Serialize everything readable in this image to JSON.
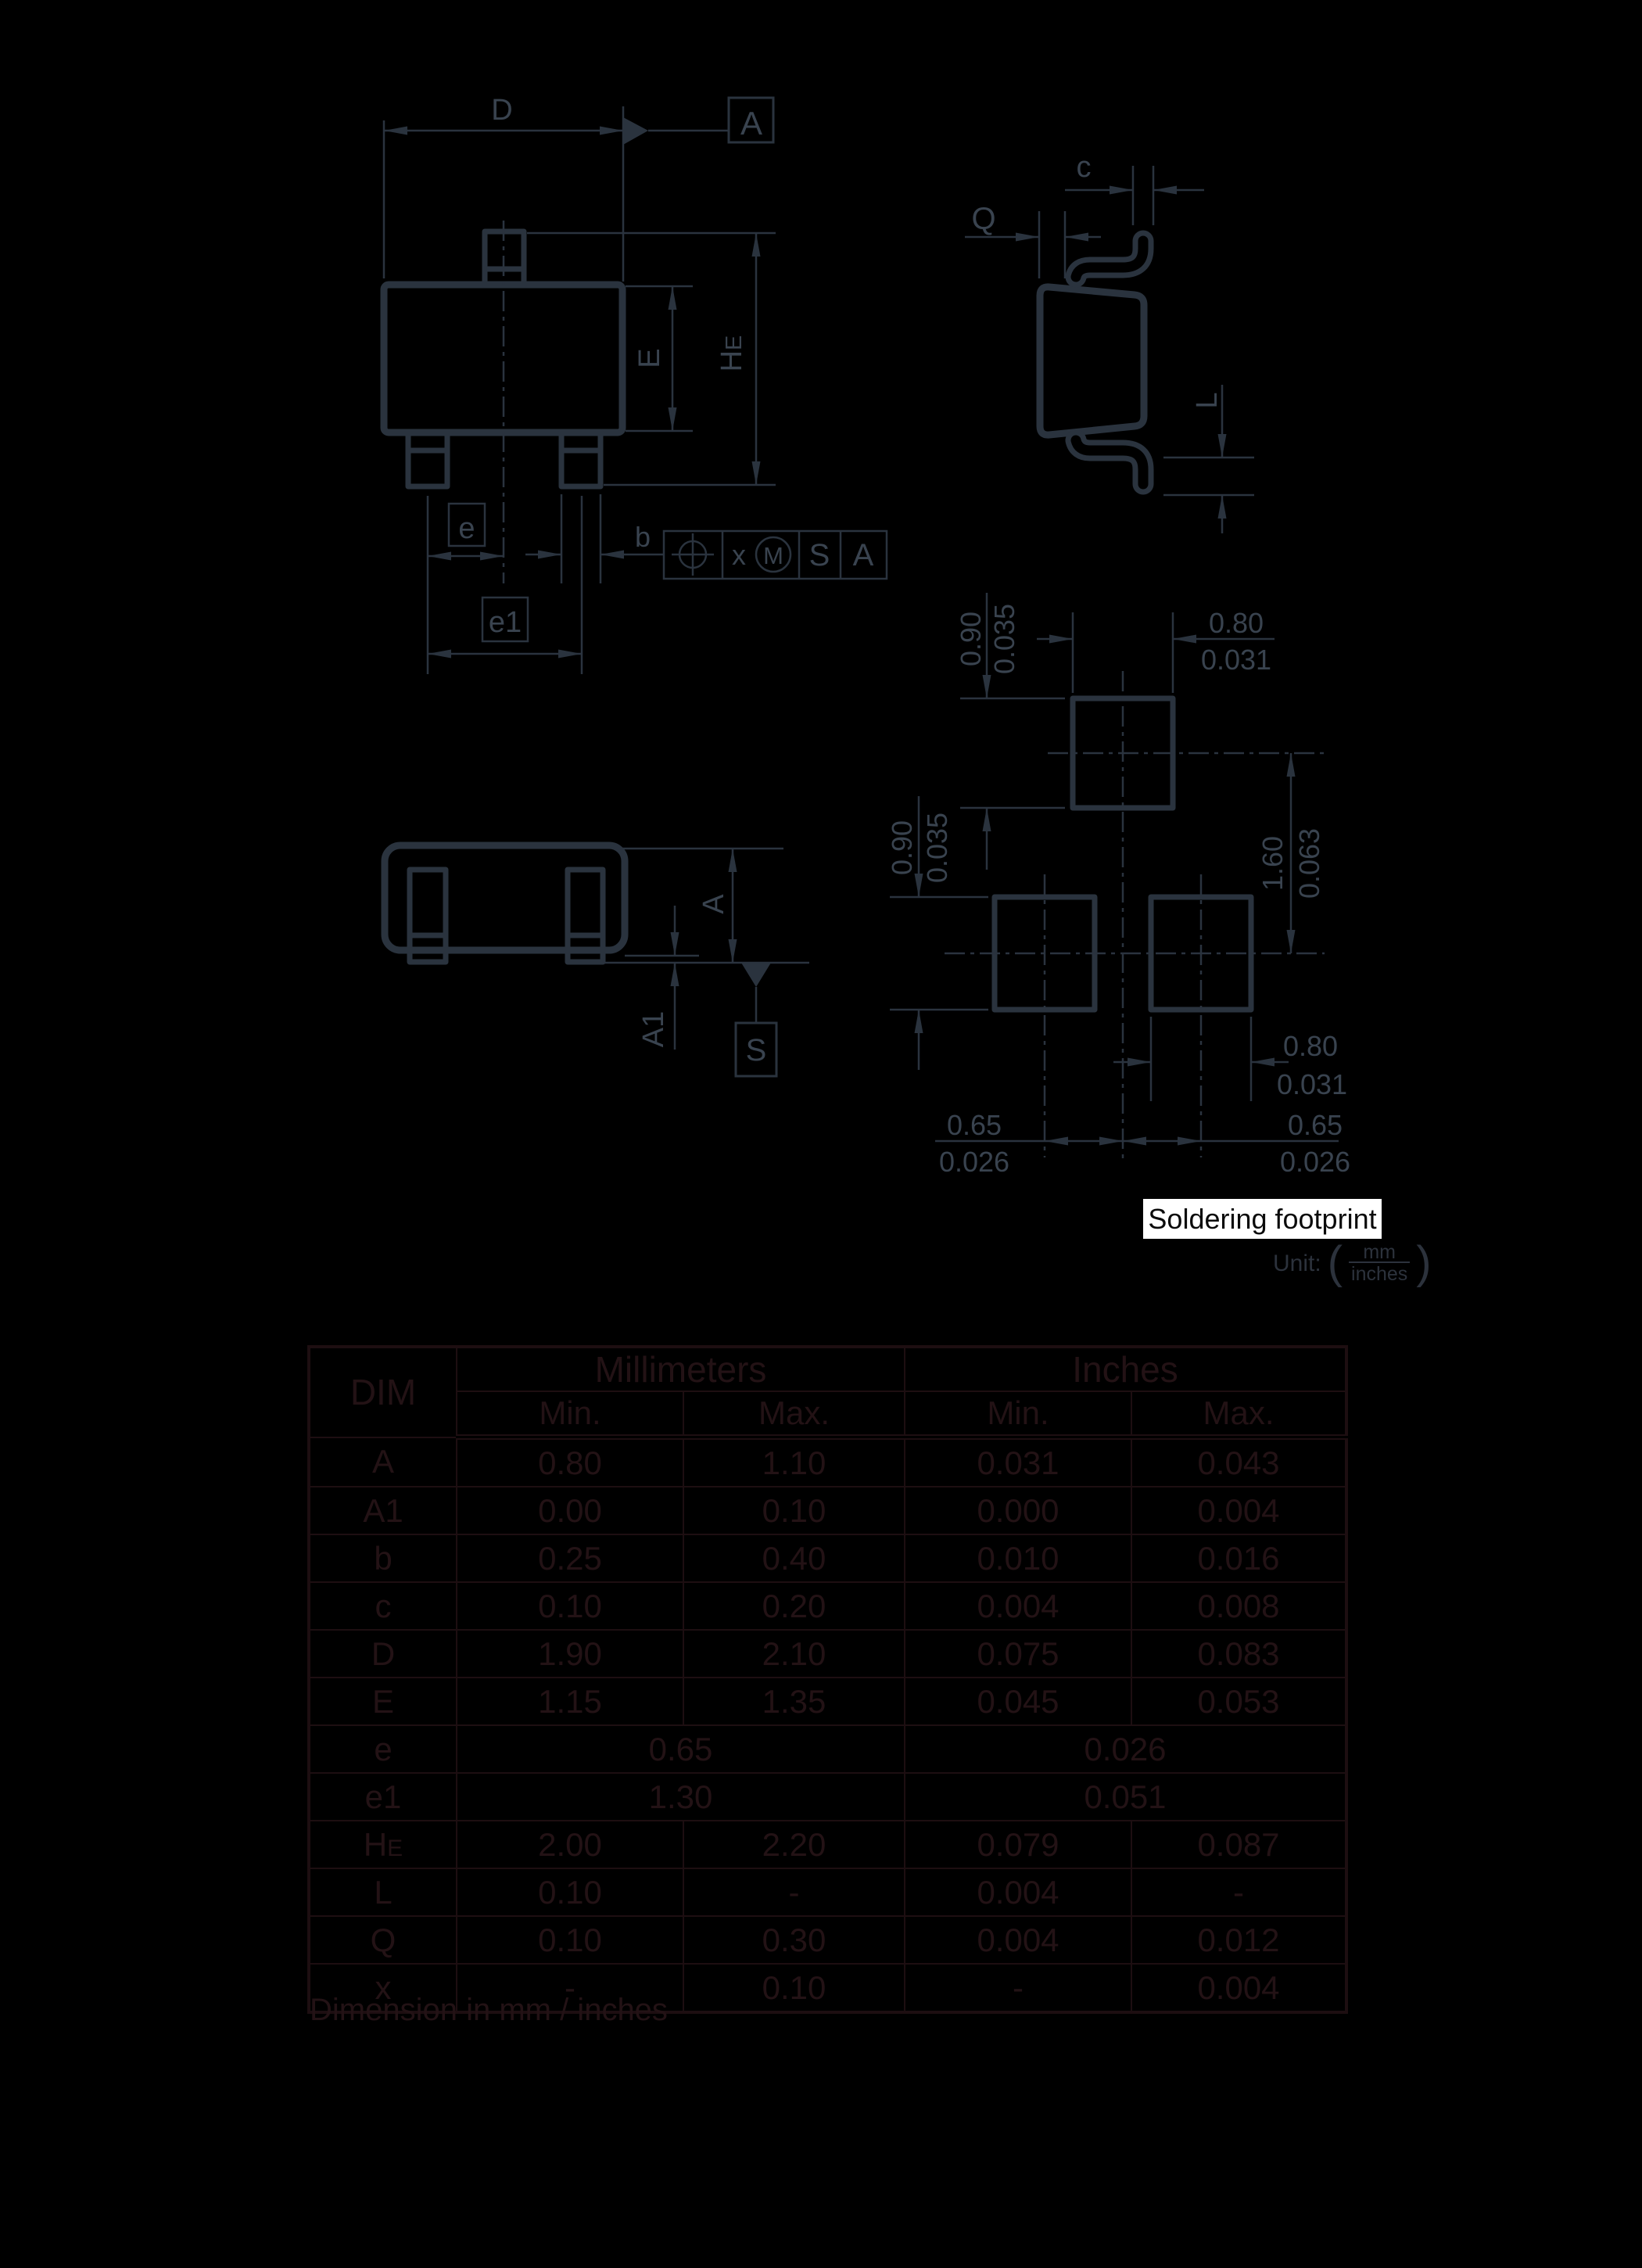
{
  "colors": {
    "background": "#000000",
    "drawing_line": "#2a333e",
    "drawing_text": "#39434f",
    "table_border": "#1d0e11",
    "table_text": "#231215",
    "unit_text": "#2c323c",
    "highlight_bg": "#ffffff",
    "highlight_text": "#0b0b0b"
  },
  "top_view": {
    "dim_d": "D",
    "dim_e": "E",
    "dim_he_main": "H",
    "dim_he_sub": "E",
    "dim_pitch": "e",
    "dim_pitch_total": "e1",
    "dim_lead_width": "b",
    "datum_a": "A",
    "fcf_tolerance": "x",
    "fcf_modifier": "M",
    "fcf_datum_primary": "S",
    "fcf_datum_secondary": "A"
  },
  "side_view": {
    "dim_c": "c",
    "dim_q": "Q",
    "dim_l": "L"
  },
  "front_view": {
    "dim_a": "A",
    "dim_a1": "A1",
    "datum_s": "S"
  },
  "footprint": {
    "title": "Soldering footprint",
    "unit_label": "Unit:",
    "unit_numerator": "mm",
    "unit_denominator": "inches",
    "top_pad_height_mm": "0.90",
    "top_pad_height_in": "0.035",
    "top_pad_width_mm": "0.80",
    "top_pad_width_in": "0.031",
    "bottom_pad_height_mm": "0.90",
    "bottom_pad_height_in": "0.035",
    "pad_pitch_vertical_mm": "1.60",
    "pad_pitch_vertical_in": "0.063",
    "bottom_pad_width_mm": "0.80",
    "bottom_pad_width_in": "0.031",
    "pad_pitch_left_mm": "0.65",
    "pad_pitch_left_in": "0.026",
    "pad_pitch_right_mm": "0.65",
    "pad_pitch_right_in": "0.026"
  },
  "table": {
    "header": {
      "dim": "DIM",
      "millimeters": "Millimeters",
      "inches": "Inches",
      "min_mm": "Min.",
      "max_mm": "Max.",
      "min_in": "Min.",
      "max_in": "Max."
    },
    "rows": [
      {
        "dim": "A",
        "mm_min": "0.80",
        "mm_max": "1.10",
        "in_min": "0.031",
        "in_max": "0.043"
      },
      {
        "dim": "A1",
        "mm_min": "0.00",
        "mm_max": "0.10",
        "in_min": "0.000",
        "in_max": "0.004"
      },
      {
        "dim": "b",
        "mm_min": "0.25",
        "mm_max": "0.40",
        "in_min": "0.010",
        "in_max": "0.016"
      },
      {
        "dim": "c",
        "mm_min": "0.10",
        "mm_max": "0.20",
        "in_min": "0.004",
        "in_max": "0.008"
      },
      {
        "dim": "D",
        "mm_min": "1.90",
        "mm_max": "2.10",
        "in_min": "0.075",
        "in_max": "0.083"
      },
      {
        "dim": "E",
        "mm_min": "1.15",
        "mm_max": "1.35",
        "in_min": "0.045",
        "in_max": "0.053"
      },
      {
        "dim": "e",
        "mm": "0.65",
        "in": "0.026"
      },
      {
        "dim": "e1",
        "mm": "1.30",
        "in": "0.051"
      },
      {
        "dim_main": "H",
        "dim_sub": "E",
        "mm_min": "2.00",
        "mm_max": "2.20",
        "in_min": "0.079",
        "in_max": "0.087"
      },
      {
        "dim": "L",
        "mm_min": "0.10",
        "mm_max": "-",
        "in_min": "0.004",
        "in_max": "-"
      },
      {
        "dim": "Q",
        "mm_min": "0.10",
        "mm_max": "0.30",
        "in_min": "0.004",
        "in_max": "0.012"
      },
      {
        "dim": "x",
        "mm_min": "-",
        "mm_max": "0.10",
        "in_min": "-",
        "in_max": "0.004"
      }
    ]
  },
  "footnote": "Dimension in mm / inches"
}
